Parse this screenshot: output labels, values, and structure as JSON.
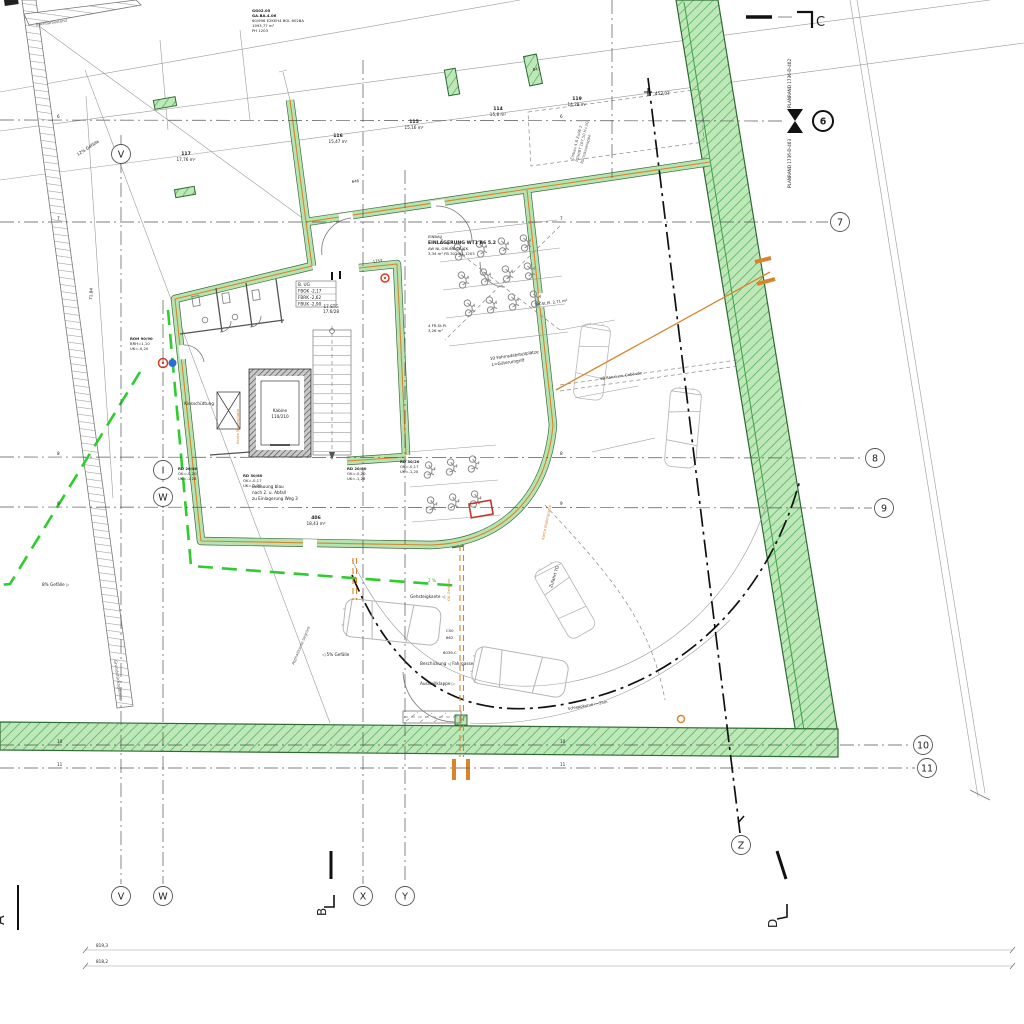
{
  "colors": {
    "site_green": "#bfe8b8",
    "hatch_green": "#58b36a",
    "wall_green": "#b5e4b0",
    "wall_core_orange": "#d9832b",
    "dash_green": "#2ecc2e",
    "marker_red": "#d93a20",
    "marker_blue": "#2b6fd4",
    "section_black": "#111111"
  },
  "title_block": {
    "lines": [
      "GG02.05",
      "GA.BA.4.06",
      "60/996 E2KEH4 BGL 602BA",
      "1993,77 m²",
      "PH 1203"
    ]
  },
  "survey": {
    "spot_height": "452,07",
    "slope_left": "12% Gefälle",
    "slope_bottom_left": "8% Gefälle ▷",
    "slope_mid": "◁ 5% Gefälle",
    "grade_green": "2 %",
    "dim_left": "71,84",
    "dim_row1": "819,3",
    "dim_row2": "818,2",
    "dim_843": "843",
    "dim_1753": "1753",
    "dim_646": "646"
  },
  "parcels": [
    {
      "no": "117",
      "area": "17,76 m²"
    },
    {
      "no": "116",
      "area": "15,47 m²"
    },
    {
      "no": "115",
      "area": "15,16 m²"
    },
    {
      "no": "114",
      "area": "15,8 m²"
    },
    {
      "no": "119",
      "area": "14,28 m²"
    },
    {
      "no": "406",
      "area": "18,43 m²"
    }
  ],
  "grid": {
    "r6": "6",
    "r7": "7",
    "r8": "8",
    "r9": "9",
    "r10": "10",
    "r11": "11",
    "cV": "V",
    "cW": "W",
    "cX": "X",
    "cY": "Y",
    "cZ": "Z",
    "cI": "I"
  },
  "sections": {
    "a": "A",
    "b": "B",
    "c": "C",
    "d": "D"
  },
  "matchline": {
    "upper": "PLANRAND 1736-D-402",
    "lower": "PLANRAND 1736-D-403"
  },
  "storage": {
    "l1": "EINBAU",
    "l2": "EINLAGERUNG WT1 B6 5.2",
    "l3": "AW NL GRUNDSTÜCK",
    "l4": "3,34 m²  FB 302  H1 1203",
    "bike_note1": "10 Fahrradabstellplätze",
    "bike_note2": "L=Güterumgriff",
    "rack1a": "4 FR-St.Pl.",
    "rack1b": "3,26 m²",
    "rack2": "FR-St.Pl. 2,71 m²"
  },
  "levels": {
    "r0": "B. UG",
    "r1": "FBOK  -2,17",
    "r2": "FBRK  -2,62",
    "r3": "FBUK  -2,90"
  },
  "elevator": {
    "l1": "Kabine",
    "l2": "110/210"
  },
  "stairs": {
    "l1": "17 STG",
    "l2": "17,6/28"
  },
  "rooms": {
    "kies": "Kiesschüttung"
  },
  "notes": {
    "bebauung1": "Bebauung blau",
    "bebauung2": "nach 2. u. Abfall",
    "bebauung3": "zu Einlagerung Weg 3",
    "gehsteig": "Gehsteigkante ◁",
    "beschickung": "Beschickung ◁ Fahrgasse",
    "ausstell": "Ausstellklappe ▷",
    "schlepp": "Schleppkurve r=25m",
    "zufahrt": "Zufahrt TG",
    "kanal": "VB Kanal zw. Gebäude",
    "grenze": "Grundstücksgrenze",
    "nachbar": "Nachbarbestand",
    "asphalt": "Asphaltkante begrünt",
    "kante_orange1": "Kante Bodenplatte",
    "kante_orange2": "Kante Bodenplatte",
    "ok_gel": "OK Gelände",
    "rot_note1": "Einbau 4.B Zu/W 2",
    "rot_note2": "ROH/BT 187,50 H+3G",
    "rot_note3": "Rückstauklappe",
    "c50": "C50",
    "b62": "862",
    "code": "6039-C"
  },
  "tags": [
    {
      "l1": "RD 20/80",
      "l2": "OK=-0,20",
      "l3": "UK=-1,28"
    },
    {
      "l1": "RD 30/80",
      "l2": "OK=-0,17",
      "l3": "UK=-1,20"
    },
    {
      "l1": "RD 20/80",
      "l2": "OK=-0,20",
      "l3": "UK=-1,28"
    },
    {
      "l1": "RD 30/20",
      "l2": "OK=-0,17",
      "l3": "UK=-1,20"
    },
    {
      "l1": "ROH 90/90",
      "l2": "BRH=1,10",
      "l3": "UK=-0,20"
    }
  ]
}
